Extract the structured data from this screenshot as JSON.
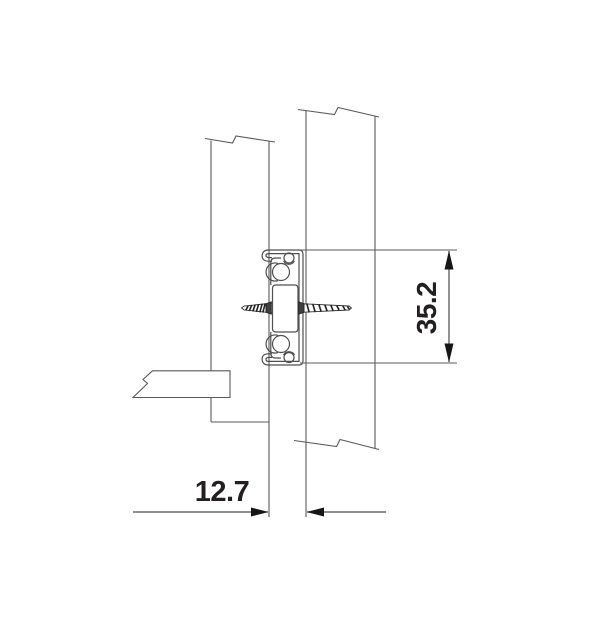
{
  "drawing": {
    "kind": "drawer-slide-cross-section",
    "dimensions": {
      "slide_height": {
        "value": "35.2"
      },
      "mount_offset": {
        "value": "12.7"
      }
    },
    "colors": {
      "background": "#ffffff",
      "panel_line": "#5a5a5b",
      "slide_line": "#4f4f51",
      "screw_dark": "#2f2f2f",
      "arrow_fill": "#161616",
      "text": "#231f20"
    }
  }
}
